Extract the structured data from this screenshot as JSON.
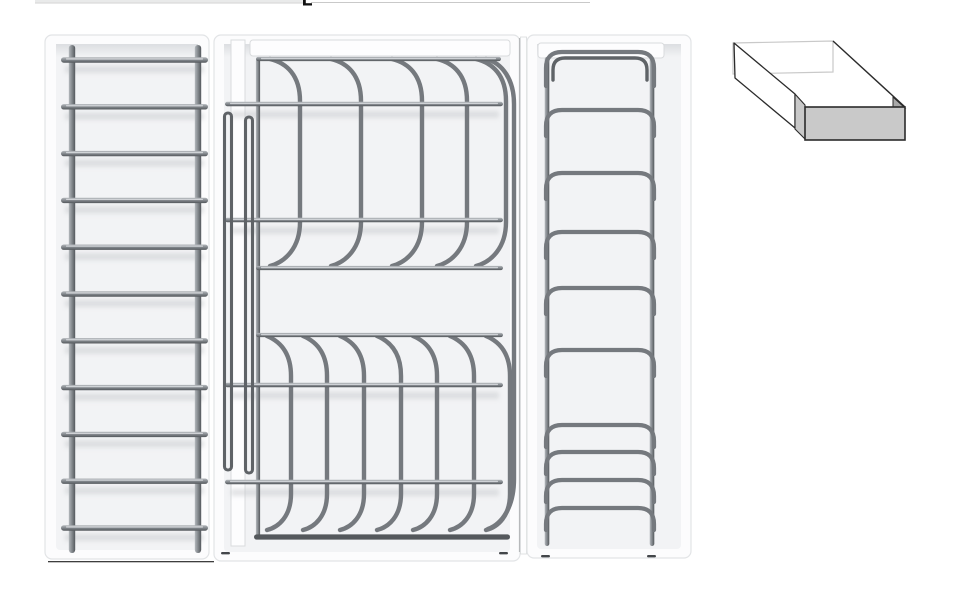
{
  "scene": {
    "kind": "product-render",
    "description": "Three white drawer-insert trays with silver wire racks (plate ladder rack, dish drainer with curved prongs, lid holder with stacked arches) and a small isometric open-drawer line icon at top right",
    "background": "#ffffff"
  },
  "colors": {
    "tray_fill": "#fcfcfd",
    "tray_inner": "#f2f3f5",
    "tray_border": "#e2e4e6",
    "tray_shadow": "#dcdee1",
    "bar_fill": "#fdfdfe",
    "bar_border": "#d9dbdd",
    "wire": "#75797e",
    "wire_hairpin": "#5f6367",
    "wire_thick": "#54585c",
    "rung_light": "#dadde0",
    "grad_top": "#b4b8bc",
    "grad_mid": "#888d92",
    "grad_bot": "#54585c",
    "smudge": "#c7cacd",
    "bottom_line": "#3e3e3e",
    "tick": "#43464a",
    "edge_line": "#b7b9bb",
    "icon_face": "#c9c9c9",
    "icon_side": "#a8a8a8",
    "icon_line": "#2b2b2b",
    "icon_back": "#c9c9c9",
    "artifact_band": "#e9eaea",
    "artifact_band_edge": "#d2d2d2",
    "artifact_line": "#c9c9c9",
    "artifact_mark": "#111111"
  },
  "artifacts": {
    "band": {
      "x": 35,
      "y": 0,
      "w": 270,
      "h": 3.5
    },
    "mark": {
      "x": 303,
      "y": 0,
      "w": 9,
      "h": 5.5
    },
    "line": {
      "x": 311,
      "y": 2,
      "w": 279,
      "h": 1
    }
  },
  "left_panel": {
    "name": "plate-ladder-rack",
    "tray": {
      "x": 45,
      "y": 35,
      "w": 164,
      "h": 524,
      "r": 7
    },
    "inner": {
      "x": 56,
      "y": 44,
      "w": 142,
      "h": 506
    },
    "rails_x": [
      72,
      198
    ],
    "rail_w": 6.4,
    "rail_y1": 45,
    "rail_y2": 553,
    "rungs": {
      "count": 11,
      "y0": 60,
      "dy": 46.8,
      "x1": 61,
      "x2": 208,
      "h": 5.4
    },
    "bottom_line": {
      "x1": 48,
      "x2": 214,
      "y": 561
    }
  },
  "middle_panel": {
    "name": "dish-drainer-rack",
    "tray": {
      "x": 214,
      "y": 35,
      "w": 306,
      "h": 526,
      "r": 7
    },
    "inner": {
      "x": 224,
      "y": 44,
      "w": 286,
      "h": 508
    },
    "divider": {
      "x": 231,
      "y": 40,
      "w": 14,
      "h": 506
    },
    "bar": {
      "x": 250,
      "y": 40,
      "w": 260,
      "h": 16,
      "r": 3
    },
    "top_wire": {
      "x1": 256,
      "x2": 501,
      "y": 59
    },
    "left_leg": {
      "x": 258,
      "y1": 59,
      "y2": 537
    },
    "cross_wires": [
      104,
      220,
      385,
      482
    ],
    "cross_x1": 225,
    "cross_x2": 503,
    "mid_wires": [
      {
        "y": 268,
        "x1": 256,
        "x2": 503
      },
      {
        "y": 335,
        "x1": 256,
        "x2": 503
      }
    ],
    "bottom_wire": {
      "y": 537,
      "x1": 254,
      "x2": 510
    },
    "top_prongs": {
      "xs": [
        270,
        331,
        392,
        437,
        476
      ],
      "bulge": 30,
      "y_top": 59,
      "y_bot": 266
    },
    "bottom_prongs": {
      "xs": [
        267,
        303,
        340,
        377,
        413,
        450,
        486
      ],
      "bulge": 24,
      "y_top": 336,
      "y_bot": 530
    },
    "tall_bracket": {
      "x_top": 486,
      "bulge_x": 514,
      "y_top": 59,
      "y_bot": 529,
      "x_bot": 488
    },
    "hairpins": [
      {
        "x": 228,
        "y1": 113,
        "y2": 470,
        "w": 7
      },
      {
        "x": 249,
        "y1": 117,
        "y2": 473,
        "w": 7
      }
    ],
    "ticks": [
      {
        "x": 221,
        "y": 552
      },
      {
        "x": 499,
        "y": 552
      }
    ],
    "right_edge_x": 519.5
  },
  "right_panel": {
    "name": "lid-holder-rack",
    "strip": {
      "x": 520.5,
      "y": 37,
      "w": 6,
      "h": 517
    },
    "tray": {
      "x": 527,
      "y": 35,
      "w": 164,
      "h": 523,
      "r": 7
    },
    "inner": {
      "x": 537,
      "y": 44,
      "w": 144,
      "h": 505
    },
    "bar": {
      "x": 538,
      "y": 43,
      "w": 126,
      "h": 15,
      "r": 3
    },
    "rails_x": [
      547,
      652
    ],
    "rail_w": 4.6,
    "rail_y1": 57,
    "rail_y2": 546,
    "arch_x1": 546,
    "arch_x2": 654,
    "arch_r": 16,
    "arches": [
      {
        "y": 52,
        "stub": 34,
        "double": true
      },
      {
        "y": 110,
        "stub": 26,
        "double": false
      },
      {
        "y": 173,
        "stub": 26,
        "double": false
      },
      {
        "y": 232,
        "stub": 26,
        "double": false
      },
      {
        "y": 288,
        "stub": 26,
        "double": false
      },
      {
        "y": 350,
        "stub": 26,
        "double": false
      },
      {
        "y": 425,
        "stub": 22,
        "double": false
      },
      {
        "y": 452,
        "stub": 22,
        "double": false
      },
      {
        "y": 480,
        "stub": 22,
        "double": false
      },
      {
        "y": 508,
        "stub": 22,
        "double": false
      }
    ],
    "ticks": [
      {
        "x": 541,
        "y": 555
      },
      {
        "x": 647,
        "y": 555
      }
    ]
  },
  "drawer_icon": {
    "name": "open-drawer-box-icon",
    "back": [
      [
        733,
        43
      ],
      [
        833,
        41
      ],
      [
        833,
        72
      ],
      [
        733,
        74
      ]
    ],
    "left_face": [
      [
        734,
        43
      ],
      [
        795,
        94
      ],
      [
        795,
        128
      ],
      [
        735,
        78
      ]
    ],
    "left_cut": [
      [
        795,
        94
      ],
      [
        805,
        105
      ],
      [
        806,
        140
      ],
      [
        795,
        129
      ]
    ],
    "right_rim": {
      "x1": 833,
      "y1": 41,
      "x2": 905,
      "y2": 107
    },
    "right_inner": [
      [
        893,
        97
      ],
      [
        905,
        108
      ],
      [
        893,
        108
      ]
    ],
    "front": {
      "x": 805,
      "y": 107,
      "w": 100,
      "h": 33
    }
  }
}
